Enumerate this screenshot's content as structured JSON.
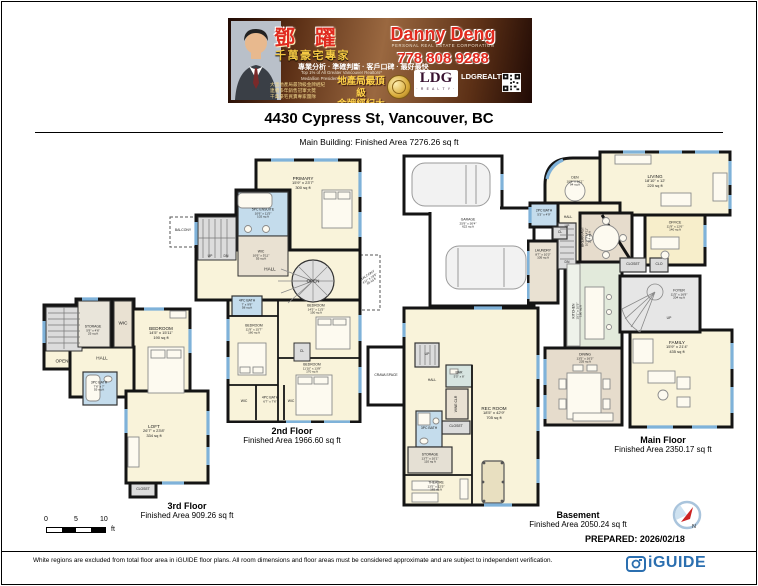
{
  "banner": {
    "agent_name_cn": "鄧 躍",
    "agent_title_cn": "千萬豪宅專家",
    "tagline_cn": "專業分析 · 準確判斷 · 客戶口碑 · 最好最快",
    "credential1": "Top 1% of All Greater Vancouver Realtors*",
    "credential2": "Medallion President's Club Award Winner",
    "tiny_cn1": "大溫地產局最頂級金牌經紀",
    "tiny_cn2": "連續多年銷售冠軍大獎",
    "tiny_cn3": "千萬豪宅買賣專家團隊",
    "award_cn1": "地產局最頂級",
    "award_cn2": "金牌經紀大獎",
    "agent_name": "Danny Deng",
    "agent_subtitle": "PERSONAL REAL ESTATE CORPORATION",
    "phone": "778 808 9288",
    "brokerage": "LDG",
    "brokerage_sub": "· R E A L T Y ·",
    "website": "LDGREALTY.CA"
  },
  "header": {
    "title": "4430 Cypress St, Vancouver, BC",
    "subtitle": "Main Building:  Finished Area 7276.26 sq ft"
  },
  "common": {
    "up": "UP",
    "dn": "DN"
  },
  "floors": {
    "f3": {
      "caption": "3rd Floor",
      "area": "Finished Area 909.26 sq ft",
      "rooms": {
        "open": {
          "name": "OPEN"
        },
        "storage": {
          "name": "STORAGE",
          "dims": "5'9\" x 4'6\"",
          "area": "25 sq ft"
        },
        "wic": {
          "name": "WIC"
        },
        "hall": {
          "name": "HALL"
        },
        "bedroom": {
          "name": "BEDROOM",
          "dims": "14'5\" x 15'11\"",
          "area": "190 sq ft"
        },
        "bath": {
          "name": "3PC BATH",
          "dims": "7'6\" x 7'",
          "area": "55 sq ft"
        },
        "loft": {
          "name": "LOFT",
          "dims": "26'7\" x 23'8\"",
          "area": "334 sq ft"
        },
        "closet": {
          "name": "CLOSET"
        }
      }
    },
    "f2": {
      "caption": "2nd Floor",
      "area": "Finished Area 1966.60 sq ft",
      "rooms": {
        "primary": {
          "name": "PRIMARY",
          "dims": "15'9\" x 23'7\"",
          "area": "300 sq ft"
        },
        "ensuite": {
          "name": "5PC ENSUITE",
          "dims": "10'6\" x 11'5\"",
          "area": "102 sq ft"
        },
        "wic": {
          "name": "WIC",
          "dims": "10'6\" x 5'11\"",
          "area": "55 sq ft"
        },
        "hall": {
          "name": "HALL"
        },
        "open": {
          "name": "OPEN"
        },
        "balcony_right": {
          "name": "BALCONY",
          "dims": "4'11\" x 19'5\"",
          "area": "85 sq ft"
        },
        "balcony_left": {
          "name": "BALCONY"
        },
        "bath_top": {
          "name": "4PC BATH",
          "dims": "7' x 9'9\"",
          "area": "58 sq ft"
        },
        "bed_left": {
          "name": "BEDROOM",
          "dims": "11'9\" x 15'7\"",
          "area": "160 sq ft"
        },
        "bed_right_top": {
          "name": "BEDROOM",
          "dims": "14'5\" x 11'5\"",
          "area": "150 sq ft"
        },
        "bed_right_bottom": {
          "name": "BEDROOM",
          "dims": "11'10\" x 13'8\"",
          "area": "170 sq ft"
        },
        "bath_bottom": {
          "name": "4PC BATH",
          "dims": "6'7\" x 7'6\""
        },
        "wic_a": {
          "name": "WIC"
        },
        "wic_b": {
          "name": "WIC"
        },
        "cl": {
          "name": "CL"
        }
      }
    },
    "main": {
      "caption": "Main Floor",
      "area": "Finished Area 2350.17 sq ft",
      "rooms": {
        "den": {
          "name": "DEN",
          "dims": "10'9\" x 10'1\"",
          "area": "94 sq ft"
        },
        "living": {
          "name": "LIVING",
          "dims": "18'10\" x 12'",
          "area": "220 sq ft"
        },
        "office": {
          "name": "OFFICE",
          "dims": "11'9\" x 12'6\"",
          "area": "140 sq ft"
        },
        "breakfast": {
          "name": "BREAKFAST",
          "dims": "10'7\" x 14'11\"",
          "area": "214 sq ft"
        },
        "kitchen": {
          "name": "KITCHEN",
          "dims": "15'1\" x 10'5\"",
          "area": "160 sq ft"
        },
        "dining": {
          "name": "DINING",
          "dims": "13'5\" x 16'3\"",
          "area": "235 sq ft"
        },
        "family": {
          "name": "FAMILY",
          "dims": "15'9\" x 21'4\"",
          "area": "435 sq ft"
        },
        "foyer": {
          "name": "FOYER",
          "dims": "11'5\" x 16'9\"",
          "area": "204 sq ft"
        },
        "laundry": {
          "name": "LAUNDRY",
          "dims": "8'7\" x 10'3\"",
          "area": "105 sq ft"
        },
        "bath2": {
          "name": "2PC BATH",
          "dims": "5'3\" x 4'9\""
        },
        "garage": {
          "name": "GARAGE",
          "dims": "25'9\" x 30'4\"",
          "area": "622 sq ft"
        },
        "hall": {
          "name": "HALL"
        },
        "closet": {
          "name": "CLOSET"
        },
        "clo": {
          "name": "CLO"
        },
        "cl": {
          "name": "CL"
        }
      }
    },
    "bsmt": {
      "caption": "Basement",
      "area": "Finished Area 2050.24 sq ft",
      "rooms": {
        "crawlspace": {
          "name": "CRAWLSPACE"
        },
        "hall": {
          "name": "HALL"
        },
        "bar": {
          "name": "BAR",
          "dims": "5'5\" x 8'"
        },
        "wine": {
          "name": "WINE CLR"
        },
        "closet": {
          "name": "CLOSET"
        },
        "bath": {
          "name": "3PC BATH"
        },
        "storage": {
          "name": "STORAGE",
          "dims": "13'7\" x 10'1\"",
          "area": "110 sq ft"
        },
        "theatre": {
          "name": "THEATRE",
          "dims": "13'5\" x 12'5\"",
          "area": "165 sq ft"
        },
        "rec": {
          "name": "REC ROOM",
          "dims": "18'5\" x 42'9\"",
          "area": "705 sq ft"
        }
      }
    }
  },
  "scale": {
    "n0": "0",
    "n5": "5",
    "n10": "10",
    "unit": "ft"
  },
  "compass": {
    "n": "N"
  },
  "prepared": "PREPARED: 2026/02/18",
  "footer": {
    "disclaimer": "White regions are excluded from total floor area in iGUIDE floor plans. All room dimensions and floor areas must be considered approximate and are subject to independent verification.",
    "brand": "iGUIDE"
  },
  "colors": {
    "accent_red": "#e02b1f",
    "gold": "#f5c944",
    "wall": "#141414",
    "room_cream": "#f9f3da",
    "bath_blue": "#c4dcec",
    "window_blue": "#7fb2d9",
    "brand_blue": "#2b6fb0"
  }
}
